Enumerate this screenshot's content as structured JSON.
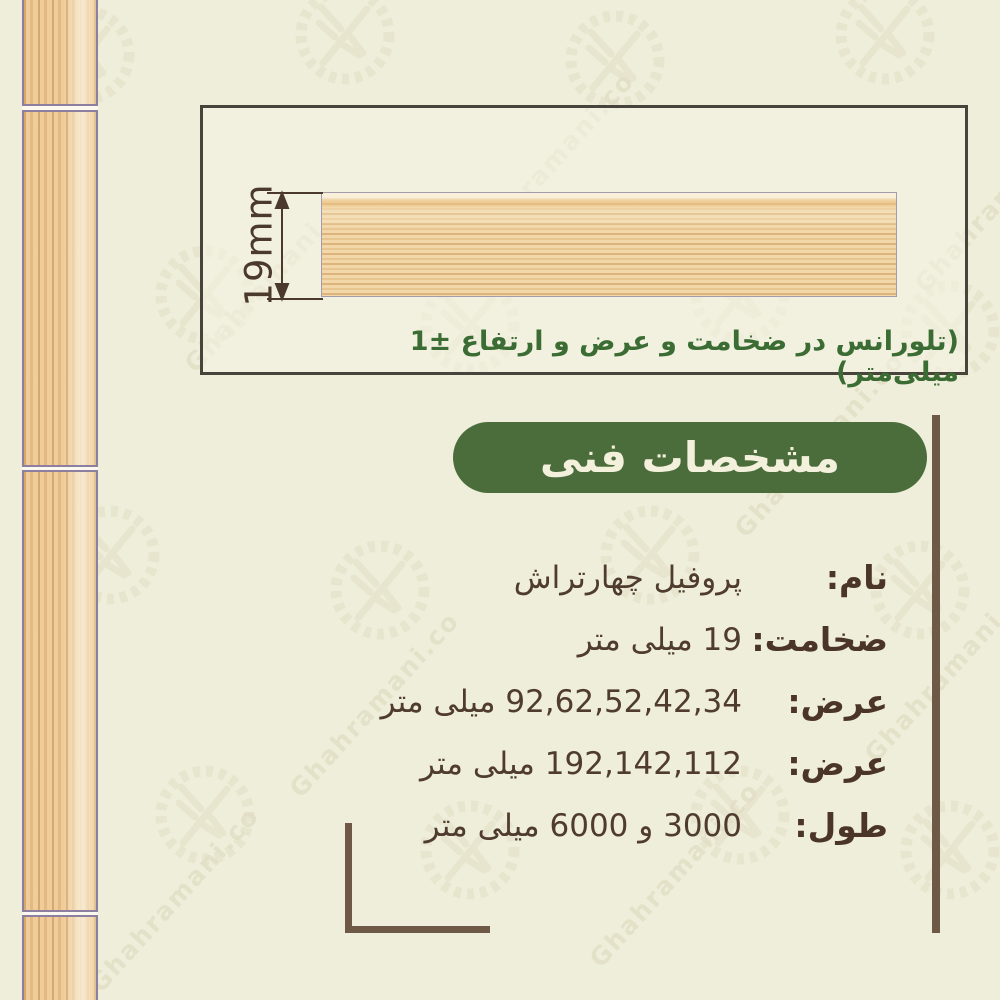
{
  "page": {
    "background_color": "#efeeda",
    "watermark_text": "Ghahramani.co"
  },
  "diagram": {
    "dimension_label": "19mm",
    "tolerance_note": "(تلورانس در ضخامت و عرض و ارتفاع ±1 میلی‌متر)",
    "note_color": "#3a6c33",
    "border_color": "#48433b"
  },
  "section": {
    "title": "مشخصات فنی",
    "badge_color": "#4a6d3b",
    "badge_text_color": "#f3f0db"
  },
  "specs": [
    {
      "label": "نام:",
      "value": "پروفیل چهارتراش"
    },
    {
      "label": "ضخامت:",
      "value": "19 میلی متر"
    },
    {
      "label": "عرض:",
      "value": "92,62,52,42,34 میلی متر"
    },
    {
      "label": "عرض:",
      "value": "192,142,112 میلی متر"
    },
    {
      "label": "طول:",
      "value": "3000 و 6000 میلی متر"
    }
  ],
  "colors": {
    "label_brown": "#4b3528",
    "value_brown": "#503c2e",
    "divider_brown": "#6e5947",
    "wood_base": "#efcc9a"
  }
}
